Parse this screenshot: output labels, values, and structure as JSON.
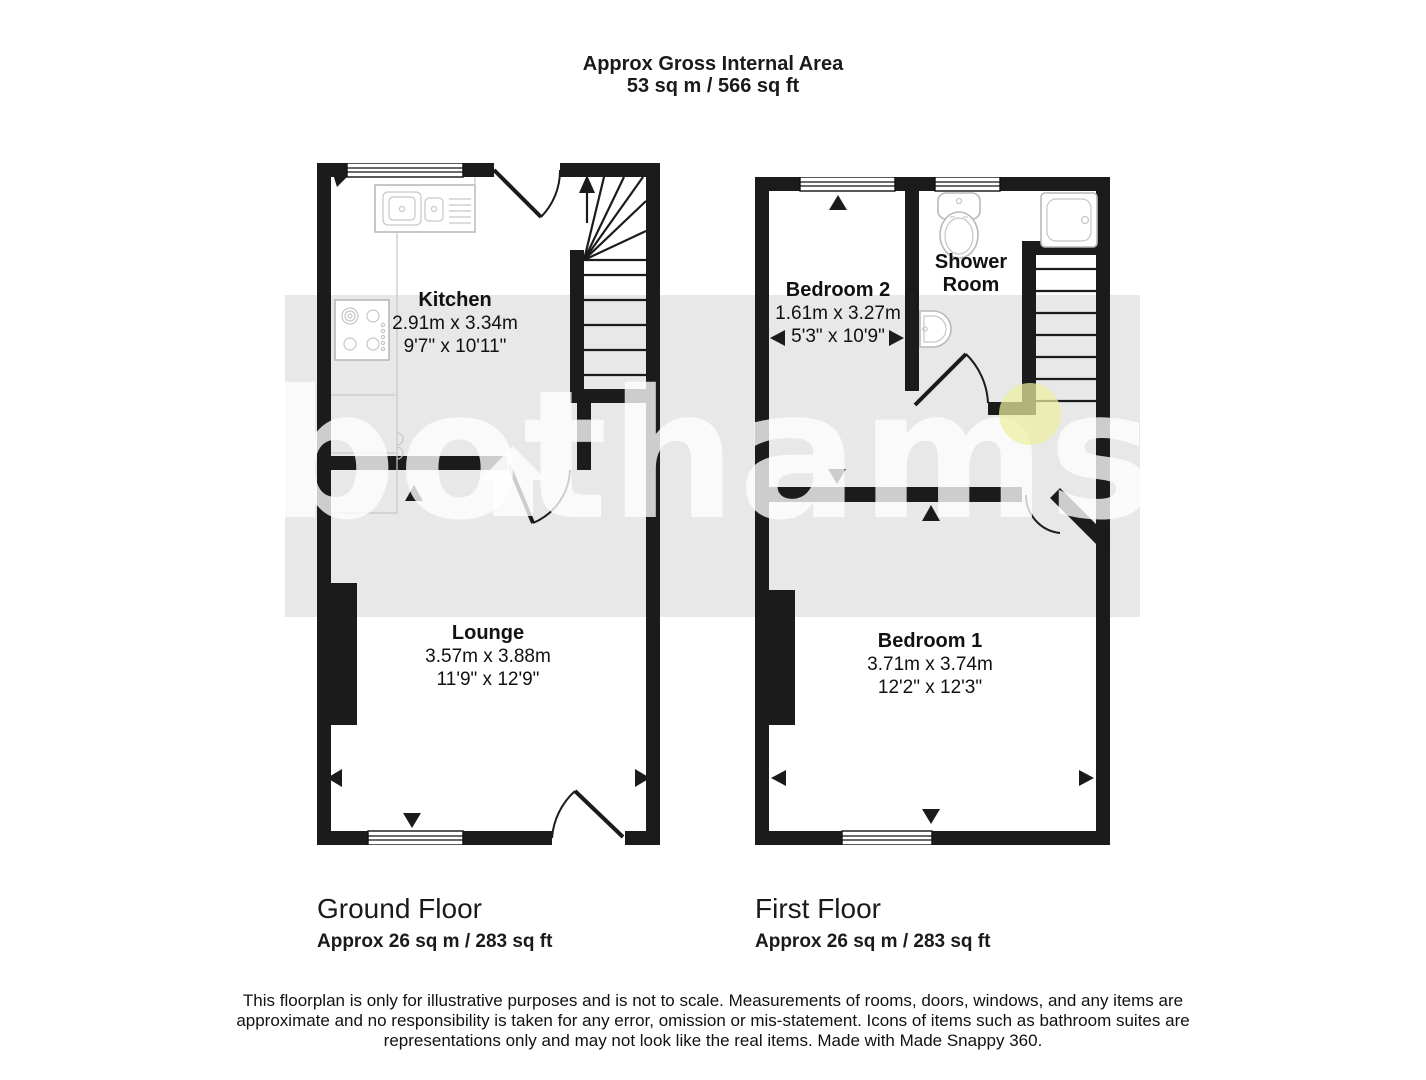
{
  "header": {
    "title": "Approx Gross Internal Area",
    "subtitle": "53 sq m / 566 sq ft"
  },
  "watermark": {
    "text": "bothams"
  },
  "ground_floor": {
    "caption": "Ground Floor",
    "area": "Approx 26 sq m / 283 sq ft",
    "rooms": {
      "kitchen": {
        "name": "Kitchen",
        "metric": "2.91m x 3.34m",
        "imperial": "9'7\" x 10'11\""
      },
      "lounge": {
        "name": "Lounge",
        "metric": "3.57m x 3.88m",
        "imperial": "11'9\" x 12'9\""
      }
    }
  },
  "first_floor": {
    "caption": "First Floor",
    "area": "Approx 26 sq m / 283 sq ft",
    "rooms": {
      "bedroom2": {
        "name": "Bedroom 2",
        "metric": "1.61m x 3.27m",
        "imperial": "5'3\" x 10'9\""
      },
      "shower_room": {
        "name": "Shower Room"
      },
      "bedroom1": {
        "name": "Bedroom 1",
        "metric": "3.71m x 3.74m",
        "imperial": "12'2\" x 12'3\""
      }
    }
  },
  "disclaimer": "This floorplan is only for illustrative purposes and is not to scale. Measurements of rooms, doors, windows, and any items are approximate and no responsibility is taken for any error, omission or mis-statement. Icons of items such as bathroom suites are representations only and may not look like the real items. Made with Made Snappy 360.",
  "colors": {
    "wall": "#1b1b1b",
    "watermark_band": "#e8e8e8",
    "watermark_text": "#ffffff",
    "hotspot": "#ecef9e"
  }
}
